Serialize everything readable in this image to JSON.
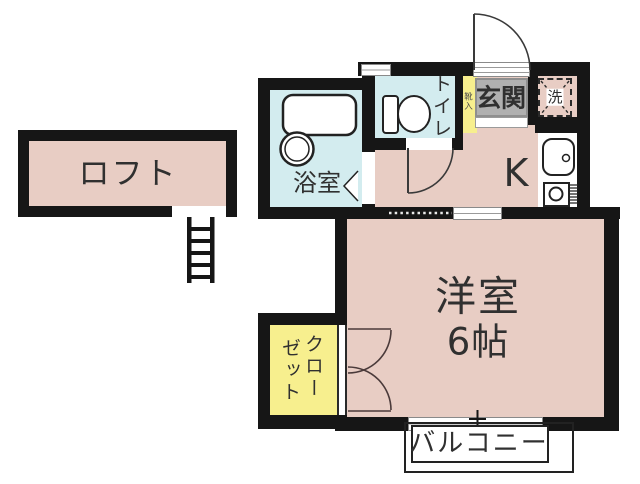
{
  "plan_title": "one-room apartment floor plan",
  "labels": {
    "loft": "ロフト",
    "bath": "浴室",
    "toilet": "トイレ",
    "entrance": "玄関",
    "laundry": "洗",
    "shoe_cabinet": "靴入",
    "kitchen": "K",
    "main_room_name": "洋室",
    "main_room_size": "6帖",
    "closet_col1": "クロー",
    "closet_col2": "ゼット",
    "balcony": "バルコニー"
  },
  "colors": {
    "wall": "#161616",
    "room_pink": "#e8cdc4",
    "wet_area_blue": "#d3ecef",
    "closet_yellow": "#f7ef8e",
    "entrance_gray": "#b0b0b0",
    "text": "#303030"
  }
}
